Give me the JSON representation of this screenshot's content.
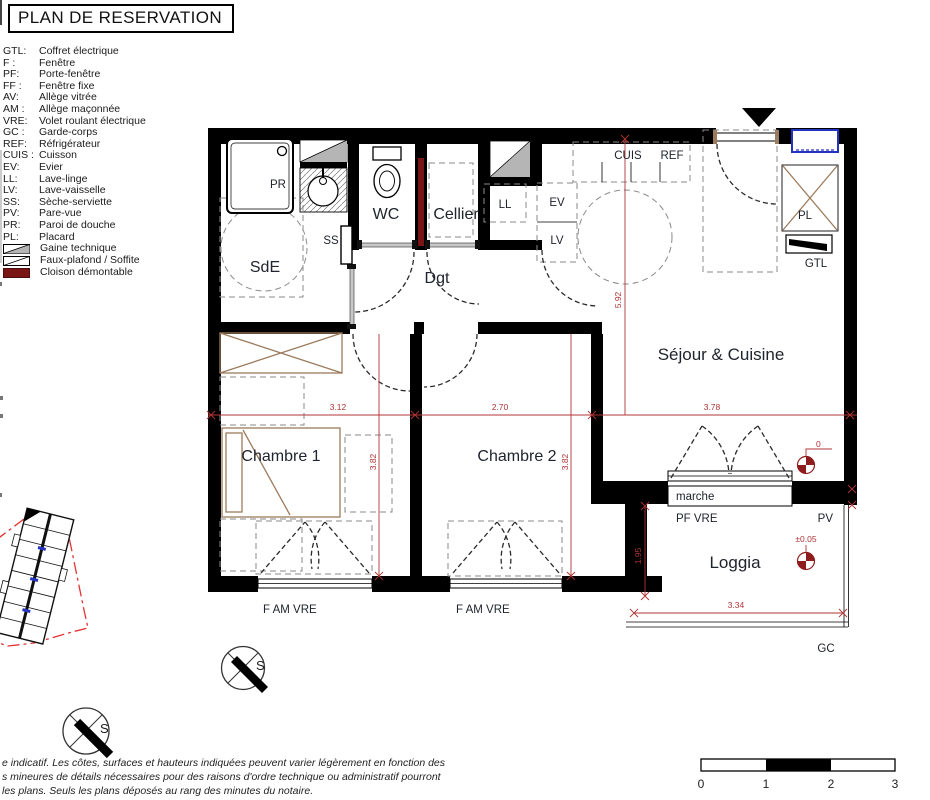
{
  "title": "PLAN DE RESERVATION",
  "legend": {
    "items": [
      {
        "abbr": "GTL:",
        "label": "Coffret électrique"
      },
      {
        "abbr": "F :",
        "label": "Fenêtre"
      },
      {
        "abbr": "PF:",
        "label": "Porte-fenêtre"
      },
      {
        "abbr": "FF :",
        "label": "Fenêtre fixe"
      },
      {
        "abbr": "AV:",
        "label": "Allège vitrée"
      },
      {
        "abbr": "AM :",
        "label": "Allège maçonnée"
      },
      {
        "abbr": "VRE:",
        "label": "Volet roulant électrique"
      },
      {
        "abbr": "GC :",
        "label": "Garde-corps"
      },
      {
        "abbr": "REF:",
        "label": "Réfrigérateur"
      },
      {
        "abbr": "CUIS :",
        "label": "Cuisson"
      },
      {
        "abbr": "EV:",
        "label": "Evier"
      },
      {
        "abbr": "LL:",
        "label": "Lave-linge"
      },
      {
        "abbr": "LV:",
        "label": "Lave-vaisselle"
      },
      {
        "abbr": "SS:",
        "label": "Sèche-serviette"
      },
      {
        "abbr": "PV:",
        "label": "Pare-vue"
      },
      {
        "abbr": "PR:",
        "label": "Paroi de douche"
      },
      {
        "abbr": "PL:",
        "label": "Placard"
      }
    ],
    "swatch_items": [
      {
        "label": "Gaine technique"
      },
      {
        "label": "Faux-plafond / Soffite"
      },
      {
        "label": "Cloison démontable"
      }
    ]
  },
  "plan": {
    "rooms": {
      "sde": "SdE",
      "wc": "WC",
      "cellier": "Cellier",
      "dgt": "Dgt",
      "sejour": "Séjour & Cuisine",
      "chambre1": "Chambre 1",
      "chambre2": "Chambre 2",
      "loggia": "Loggia"
    },
    "equipment": {
      "pr": "PR",
      "ss": "SS",
      "ll": "LL",
      "ev": "EV",
      "lv": "LV",
      "cuis": "CUIS",
      "ref": "REF",
      "pl": "PL",
      "gtl": "GTL",
      "marche": "marche",
      "pf_vre": "PF VRE",
      "pv": "PV",
      "gc": "GC",
      "f_am_vre": "F AM VRE"
    },
    "dimensions": {
      "d312": "3.12",
      "d270": "2.70",
      "d378": "3.78",
      "d382a": "3.82",
      "d382b": "3.82",
      "d592": "5.92",
      "d195": "1.95",
      "d334": "3.34"
    },
    "levels": {
      "zero": "0",
      "loggia": "±0.05"
    }
  },
  "compass": {
    "letter": "S"
  },
  "scalebar": {
    "t0": "0",
    "t1": "1",
    "t2": "2",
    "t3": "3"
  },
  "disclaimer": {
    "line1": "e indicatif. Les côtes, surfaces et hauteurs indiquées peuvent varier légèrement en fonction des",
    "line2": "s mineures de détails nécessaires pour des raisons d'ordre technique ou administratif pourront",
    "line3": "les plans. Seuls les plans déposés au rang des minutes du notaire."
  },
  "colors": {
    "dim_red": "#b03434",
    "level_red": "#8e1c1c",
    "cloison_red": "#7a1515",
    "furniture_brown": "#9c7b5c",
    "niche_blue": "#2433c0",
    "gaine_gray": "#b5b5b5"
  }
}
